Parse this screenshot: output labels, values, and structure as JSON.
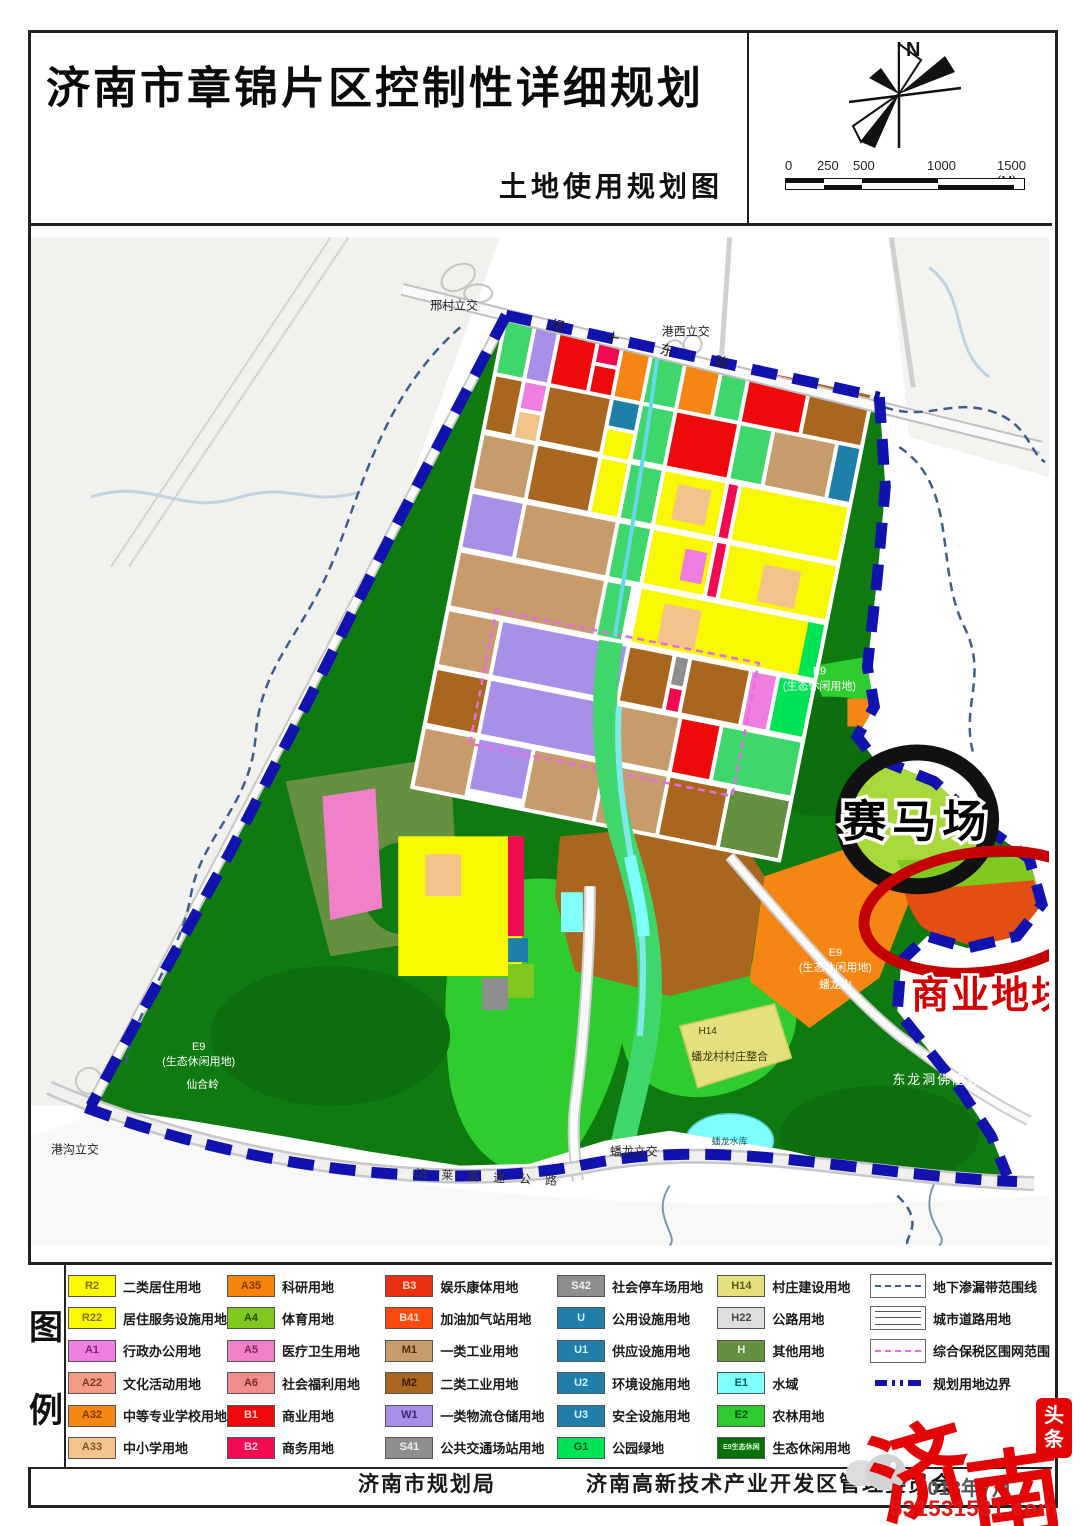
{
  "header": {
    "title": "济南市章锦片区控制性详细规划",
    "subtitle": "土地使用规划图",
    "north_label": "N",
    "scale_ticks": [
      "0",
      "250",
      "500",
      "1000",
      "1500 (M)"
    ]
  },
  "map": {
    "annotations": {
      "racecourse": "赛马场",
      "commercial": "商业地块"
    },
    "labels": {
      "road_top": "经十东路",
      "highway": "济莱高速公路",
      "interchange_xingcun": "邢村立交",
      "interchange_gangxi": "港西立交",
      "interchange_gangou": "港沟立交",
      "interchange_panlong": "蟠龙立交",
      "e9_code": "E9",
      "e9_name": "(生态休闲用地)",
      "mountain_west": "仙合岭",
      "mountain_south": "蟠龙山",
      "h14_code": "H14",
      "h14_name": "蟠龙村村庄整合",
      "reservoir": "蟠龙水库",
      "temple": "东龙洞佛隐寺"
    },
    "colors": {
      "boundary": "#1212AE",
      "bonded_zone_fence": "#E66CE6",
      "seepage_line": "#3E5E8E",
      "annotation_circle": "#111111",
      "annotation_ellipse": "#C40000"
    }
  },
  "legend": {
    "title_chars": [
      "图",
      "例"
    ],
    "cols": [
      {
        "items": [
          {
            "code": "R2",
            "label": "二类居住用地",
            "color": "#F8F800",
            "tc": "#8a6d00"
          },
          {
            "code": "R22",
            "label": "居住服务设施用地",
            "color": "#F8F800",
            "tc": "#8a6d00"
          },
          {
            "code": "A1",
            "label": "行政办公用地",
            "color": "#EE7EE0",
            "tc": "#7a2a6e"
          },
          {
            "code": "A22",
            "label": "文化活动用地",
            "color": "#F49B86",
            "tc": "#7a3a2a"
          },
          {
            "code": "A32",
            "label": "中等专业学校用地",
            "color": "#F58613",
            "tc": "#7a3a00"
          },
          {
            "code": "A33",
            "label": "中小学用地",
            "color": "#F2C48C",
            "tc": "#7a5a2a"
          }
        ]
      },
      {
        "items": [
          {
            "code": "A35",
            "label": "科研用地",
            "color": "#F5820B",
            "tc": "#7a3a00"
          },
          {
            "code": "A4",
            "label": "体育用地",
            "color": "#7FC820",
            "tc": "#2a4a00"
          },
          {
            "code": "A5",
            "label": "医疗卫生用地",
            "color": "#F080C8",
            "tc": "#7a2a5a"
          },
          {
            "code": "A6",
            "label": "社会福利用地",
            "color": "#F08C8C",
            "tc": "#7a2a2a"
          },
          {
            "code": "B1",
            "label": "商业用地",
            "color": "#EE0A0A",
            "tc": "#ffd0d0"
          },
          {
            "code": "B2",
            "label": "商务用地",
            "color": "#F00A50",
            "tc": "#ffd0dc"
          }
        ]
      },
      {
        "items": [
          {
            "code": "B3",
            "label": "娱乐康体用地",
            "color": "#E83010",
            "tc": "#ffd8c8"
          },
          {
            "code": "B41",
            "label": "加油加气站用地",
            "color": "#FF4A0E",
            "tc": "#ffe0d0"
          },
          {
            "code": "M1",
            "label": "一类工业用地",
            "color": "#C69C6D",
            "tc": "#4a3010"
          },
          {
            "code": "M2",
            "label": "二类工业用地",
            "color": "#A8661E",
            "tc": "#3a2000"
          },
          {
            "code": "W1",
            "label": "一类物流仓储用地",
            "color": "#A890E8",
            "tc": "#3a2a6a"
          },
          {
            "code": "S41",
            "label": "公共交通场站用地",
            "color": "#8E8E8E",
            "tc": "#f0f0f0"
          }
        ]
      },
      {
        "items": [
          {
            "code": "S42",
            "label": "社会停车场用地",
            "color": "#8E8E8E",
            "tc": "#f0f0f0"
          },
          {
            "code": "U",
            "label": "公用设施用地",
            "color": "#1F7FA8",
            "tc": "#d8f0ff"
          },
          {
            "code": "U1",
            "label": "供应设施用地",
            "color": "#1F7FA8",
            "tc": "#d8f0ff"
          },
          {
            "code": "U2",
            "label": "环境设施用地",
            "color": "#1F7FA8",
            "tc": "#d8f0ff"
          },
          {
            "code": "U3",
            "label": "安全设施用地",
            "color": "#1F7FA8",
            "tc": "#d8f0ff"
          },
          {
            "code": "G1",
            "label": "公园绿地",
            "color": "#00E356",
            "tc": "#00501e"
          }
        ]
      },
      {
        "items": [
          {
            "code": "H14",
            "label": "村庄建设用地",
            "color": "#E3E07E",
            "tc": "#5a5a10"
          },
          {
            "code": "H22",
            "label": "公路用地",
            "color": "#DEDEDE",
            "tc": "#444444"
          },
          {
            "code": "H",
            "label": "其他用地",
            "color": "#64903F",
            "tc": "#eaf5dc"
          },
          {
            "code": "E1",
            "label": "水域",
            "color": "#80FFFF",
            "tc": "#00565a"
          },
          {
            "code": "E2",
            "label": "农林用地",
            "color": "#2ECC2E",
            "tc": "#0a4a0a"
          },
          {
            "code": "E9生态休闲",
            "label": "生态休闲用地",
            "color": "#0A700A",
            "tc": "#d8ffd8"
          }
        ]
      },
      {
        "items": [
          {
            "symbol": "dashed-navy",
            "label": "地下渗漏带范围线",
            "color": "#3E5E8E"
          },
          {
            "symbol": "triple-line",
            "label": "城市道路用地",
            "color": "#555555"
          },
          {
            "symbol": "dashed-magenta",
            "label": "综合保税区围网范围",
            "color": "#E66CE6"
          },
          {
            "symbol": "dash-dot-blue",
            "label": "规划用地边界",
            "color": "#1212AE"
          }
        ]
      }
    ]
  },
  "footer": {
    "org1": "济南市规划局",
    "org2": "济南高新技术产业开发区管理委员会",
    "date": "2018年7月"
  },
  "watermark": {
    "brand_char1": "济",
    "brand_char2": "南",
    "seal_char1": "头",
    "seal_char2": "条",
    "url": "531531531.com"
  }
}
